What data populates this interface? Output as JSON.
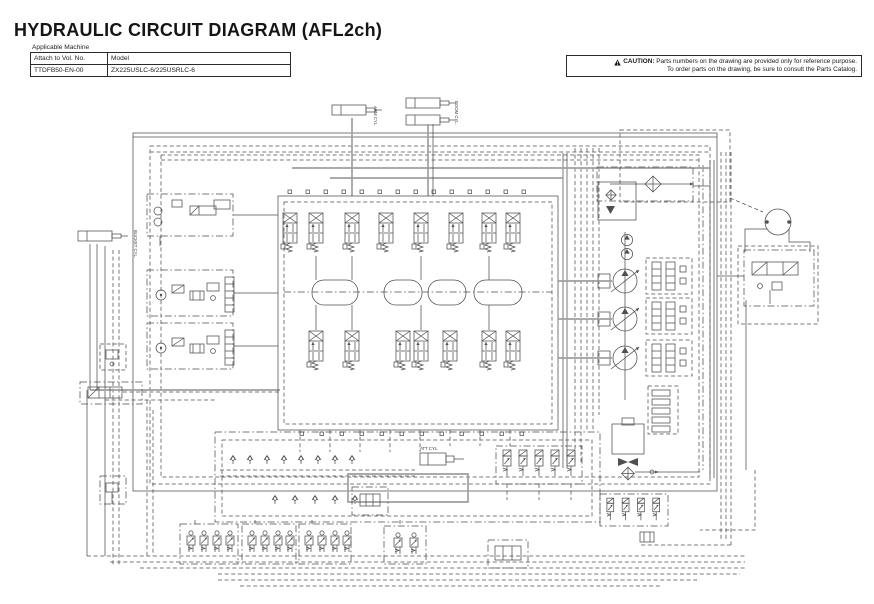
{
  "page": {
    "title": "HYDRAULIC CIRCUIT DIAGRAM (AFL2ch)",
    "machine_table": {
      "caption": "Applicable Machine",
      "headers": [
        "Attach to Vol. No.",
        "Model"
      ],
      "row": [
        "TTDFB50-EN-00",
        "ZX225USLC-6/225USRLC-6"
      ]
    },
    "caution": {
      "label": "CAUTION:",
      "line1": "Parts numbers on the drawing are provided only for reference purpose.",
      "line2": "To order parts on the drawing, be sure to consult the Parts Catalog."
    },
    "diagram": {
      "labels": {
        "cylinder_top_single": "ARM CYL.",
        "cylinder_top_pair": "BOOM CYL.",
        "cylinder_left": "BUCKET CYL.",
        "cylinder_bottom": "ATT CYL."
      },
      "colors": {
        "line": "#4f4f4f",
        "hose": "#9f9f9f",
        "background": "#ffffff"
      }
    }
  }
}
